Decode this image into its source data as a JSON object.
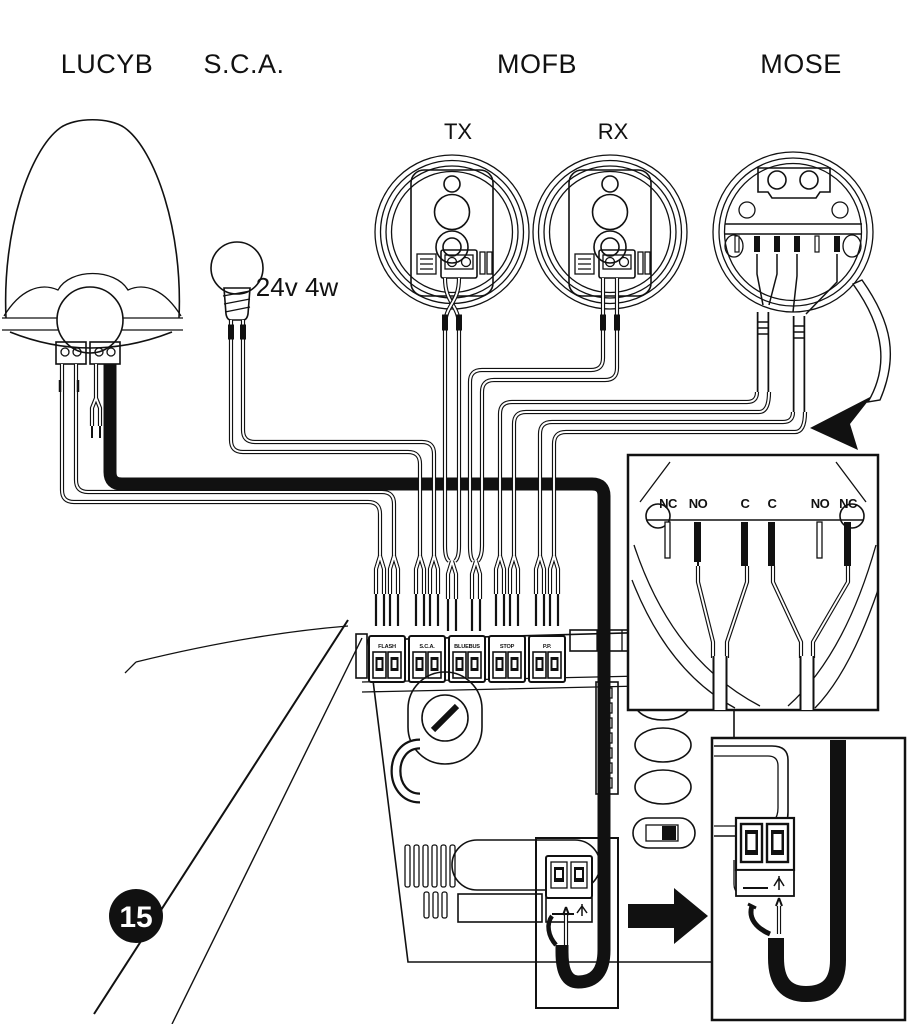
{
  "figure": {
    "badge": "15"
  },
  "labels": {
    "lucyb": "LUCYB",
    "sca": "S.C.A.",
    "mofb": "MOFB",
    "tx": "TX",
    "rx": "RX",
    "mose": "MOSE",
    "bulb_spec": "24v 4w"
  },
  "board": {
    "terminals": [
      {
        "label": "FLASH"
      },
      {
        "label": "S.C.A."
      },
      {
        "label": "BLUEBUS"
      },
      {
        "label": "STOP"
      },
      {
        "label": "P.P."
      }
    ]
  },
  "inset_mose": {
    "contacts": [
      "NC",
      "NO",
      "C",
      "C",
      "NO",
      "NC"
    ]
  },
  "colors": {
    "ink": "#111111",
    "background": "#ffffff"
  }
}
